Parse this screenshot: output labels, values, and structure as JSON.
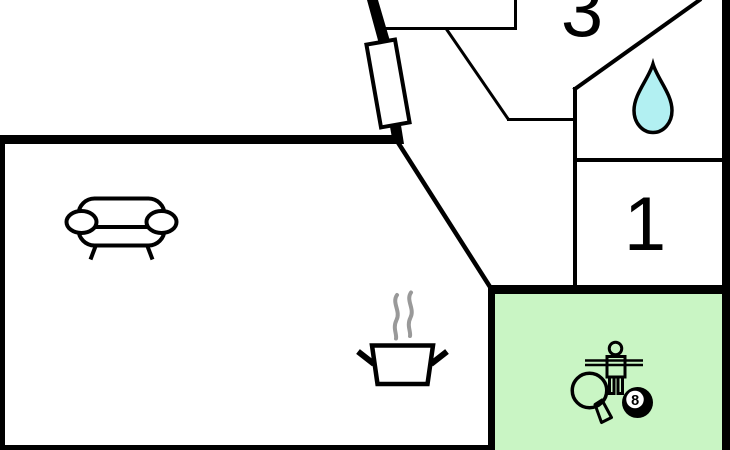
{
  "labels": {
    "room_3": "3",
    "room_1": "1",
    "eight_ball": "8"
  },
  "colors": {
    "wall": "#000000",
    "background": "#ffffff",
    "game_room_fill": "#c9f5c4",
    "water_drop_fill": "#b2f0f2",
    "steam": "#999999",
    "ball": "#000000",
    "ball_badge": "#ffffff"
  },
  "icons": {
    "bathroom": "water-drop",
    "living_room": "sofa",
    "kitchen": "cooking-pot-with-steam",
    "game_room": [
      "table-tennis-paddle",
      "foosball-player",
      "billiard-8-ball"
    ],
    "entrance": "door-leaf"
  }
}
